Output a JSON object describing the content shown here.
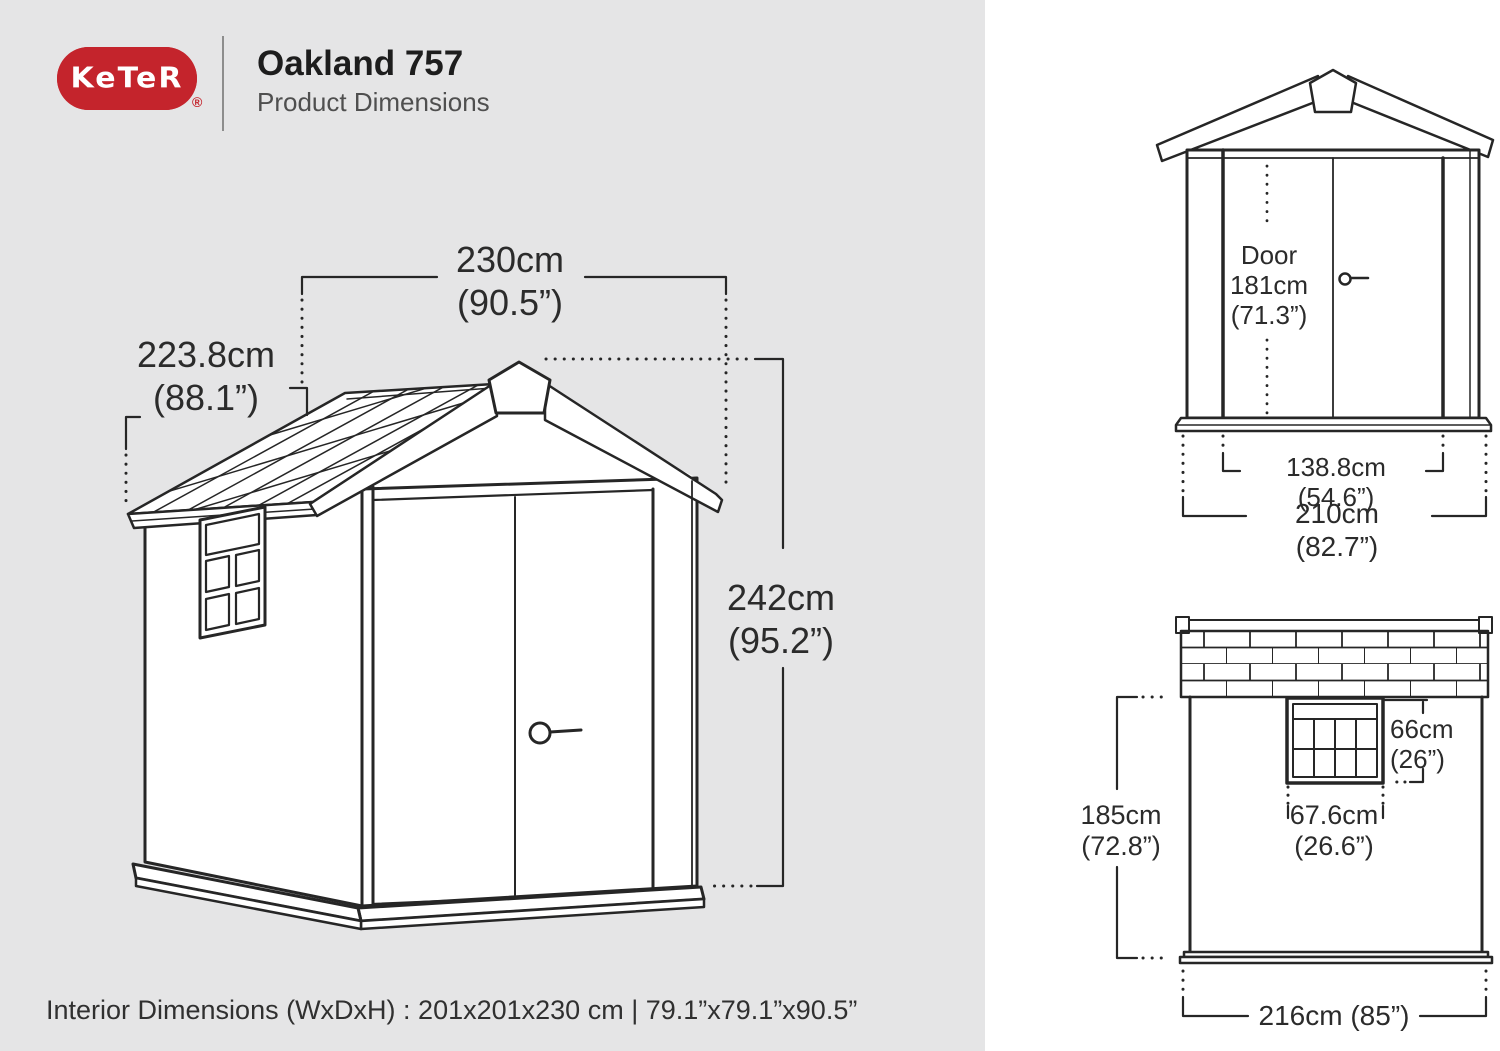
{
  "colors": {
    "brand_red": "#c4242c",
    "left_panel_bg": "#e5e5e6",
    "line_color": "#262626",
    "text_color": "#2b2b2b"
  },
  "header": {
    "brand": "KeTeR",
    "registered_mark": "®",
    "title": "Oakland 757",
    "subtitle": "Product Dimensions"
  },
  "main_view": {
    "width": "230cm\n(90.5”)",
    "depth": "223.8cm\n(88.1”)",
    "height": "242cm\n(95.2”)"
  },
  "front_view": {
    "door": "Door\n181cm\n(71.3”)",
    "door_width": "138.8cm (54.6”)",
    "overall_width": "210cm (82.7”)"
  },
  "side_view": {
    "window_height": "66cm\n(26”)",
    "window_width": "67.6cm\n(26.6”)",
    "wall_height": "185cm\n(72.8”)",
    "overall_width": "216cm (85”)"
  },
  "footer": {
    "interior_dimensions": "Interior Dimensions (WxDxH) : 201x201x230 cm | 79.1”x79.1”x90.5”"
  }
}
